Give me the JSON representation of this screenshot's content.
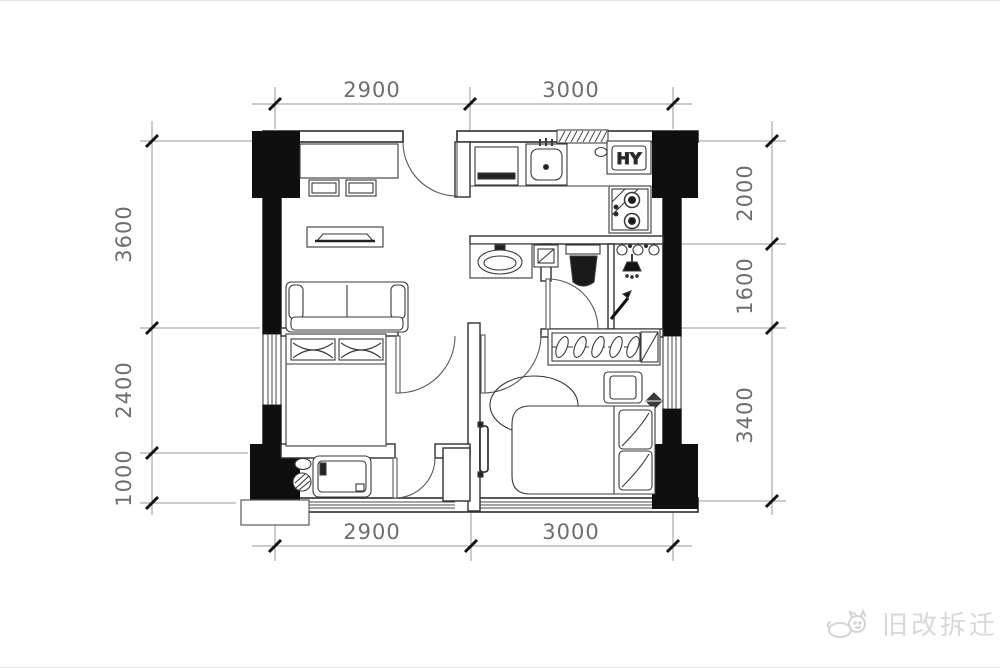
{
  "plan": {
    "type": "apartment-floor-plan",
    "colors": {
      "wall_line": "#2f2f2f",
      "structural_column": "#0f0f0f",
      "furniture_line": "#3a3a3a",
      "dimension_line": "#9a9a9a",
      "dimension_text": "#6e6e6e",
      "background": "#ffffff",
      "watermark": "#d8d8d8"
    },
    "labels": {
      "water_heater": "HY"
    },
    "dimensions": {
      "top": [
        {
          "label": "2900"
        },
        {
          "label": "3000"
        }
      ],
      "bottom": [
        {
          "label": "2900"
        },
        {
          "label": "3000"
        }
      ],
      "left": [
        {
          "label": "3600"
        },
        {
          "label": "2400"
        },
        {
          "label": "1000"
        }
      ],
      "right": [
        {
          "label": "2000"
        },
        {
          "label": "1600"
        },
        {
          "label": "3400"
        }
      ]
    }
  },
  "watermark": {
    "text": "旧改拆迁"
  }
}
